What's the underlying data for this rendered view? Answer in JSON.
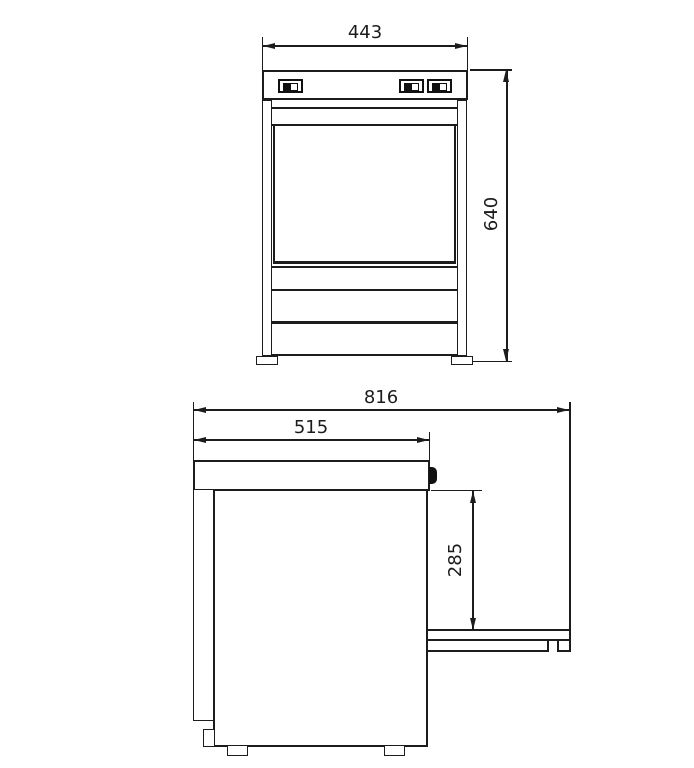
{
  "drawing": {
    "kind": "technical-drawing",
    "colors": {
      "line": "#1c1c1c",
      "background": "#ffffff"
    },
    "front_view": {
      "width_label": "443",
      "height_label": "640"
    },
    "side_view": {
      "overall_depth_label": "816",
      "body_depth_label": "515",
      "door_clearance_label": "285"
    }
  }
}
